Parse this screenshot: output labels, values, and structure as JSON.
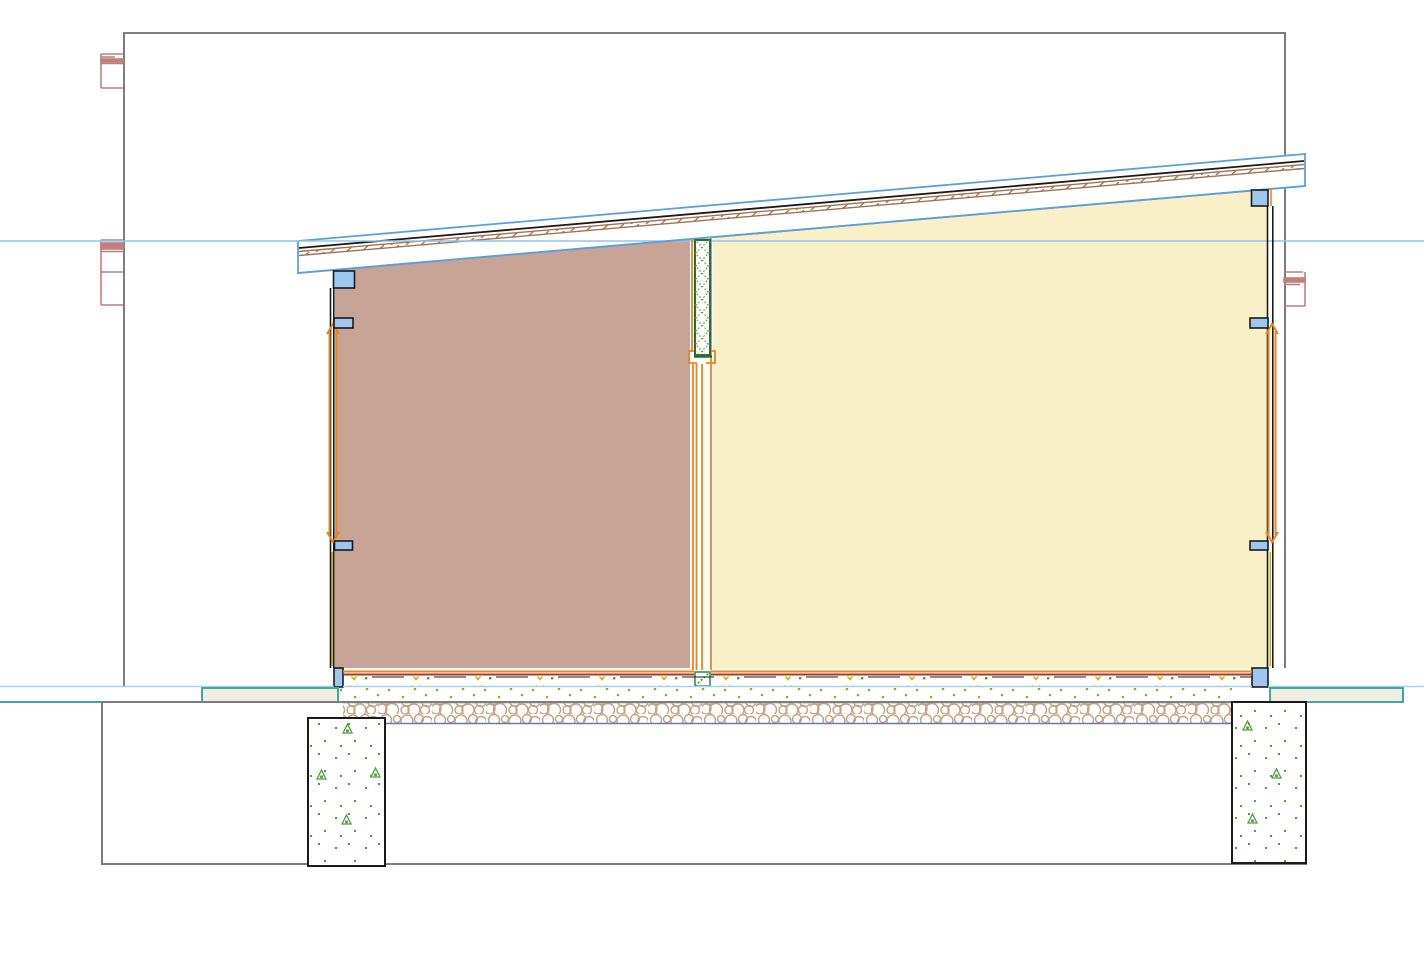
{
  "drawing": {
    "kind": "architectural-building-section",
    "description": "Cross-section of a single-storey building with mono-pitch roof, two rooms, central partition with door, strip footings and ground lines"
  },
  "colors": {
    "background": "#ffffff",
    "section_border": "#7d7d7d",
    "level_line": "#8ec6ec",
    "roof_outline": "#5f9fd8",
    "roof_deck_line": "#1a1a1a",
    "roof_wood": "#9e7352",
    "ceiling_line": "#5f9fd8",
    "room_left_fill": "#c8a496",
    "room_right_fill": "#faf0c8",
    "lumber_fill": "#9ec7f0",
    "lumber_outline": "#1a1a1a",
    "wall_line": "#1a1a1a",
    "wall_core_yellow": "#c8a21e",
    "frame_orange": "#ef841c",
    "floor_top_orange": "#ef841c",
    "floor_top_red": "#a63a20",
    "floor_blue_line": "#a5d3ee",
    "insulation_dash": "#1a1a1a",
    "insulation_tick_yellow": "#d9a918",
    "screed_dot": "#a3a32e",
    "gravel_line": "#6b77ad",
    "gravel_circle": "#c2a181",
    "ground_band_fill": "#f0ede2",
    "ground_band_edge": "#3fa8a2",
    "footing_outline": "#1a1a1a",
    "footing_mark_green": "#4f9e3f",
    "partition_outline": "#2e6b34",
    "partition_hatch": "#4f9e3f",
    "threshold_green": "#2e8b3c",
    "adjacent_structure_red": "#bf7f7f"
  }
}
